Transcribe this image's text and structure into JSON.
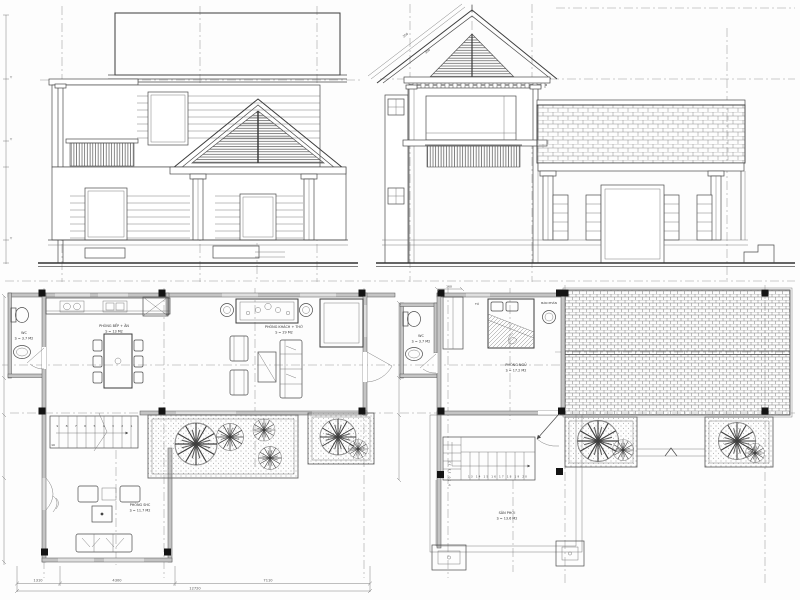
{
  "sheet": {
    "background": "#fdfdfd",
    "ink_color": "#3c3c3c",
    "wall_fill_color": "#c4c4c4",
    "column_fill_color": "#141414",
    "level_marker_glyph": "▽"
  },
  "elevations": {
    "front": {
      "description": "front elevation with tiled roof, porch gable and balcony"
    },
    "side": {
      "description": "side elevation with gable, balcony and long tiled roof",
      "roof_slope_dims": {
        "upper": "250",
        "lower": "300"
      }
    }
  },
  "ground_floor_plan": {
    "wc": {
      "name": "WC",
      "area": "S = 3.7 M2"
    },
    "kitchen_dining": {
      "name": "PHÒNG BẾP + ĂN",
      "area": "S = 13 M2"
    },
    "living_worship": {
      "name": "PHÒNG KHÁCH + THỜ",
      "area": "S = 29 M2"
    },
    "family_room": {
      "name": "PHÒNG SHC",
      "area": "S = 11.7 M2"
    },
    "stair_run_numbers": "9 8 7 6 5 4 3 2 1",
    "stair_landing_number": "10"
  },
  "first_floor_plan": {
    "wc": {
      "name": "WC",
      "area": "S = 3.7 M2"
    },
    "bedroom": {
      "name": "PHÒNG NGỦ",
      "area": "S = 17.2 M2"
    },
    "drying_yard": {
      "name": "SÂN PHƠI",
      "area": "S = 13.6 M2"
    },
    "wardrobe_label": "TỦ",
    "dressing_table_label": "BÀN PHẤN",
    "stair_run_numbers": "13 14 15 16 17 18 19 20",
    "stair_flight_numbers": "9 10 11 12",
    "top_dim": "160"
  },
  "dimensions": {
    "bottom_segments": [
      "1310",
      "4300",
      "7110"
    ],
    "bottom_total": "12720"
  }
}
